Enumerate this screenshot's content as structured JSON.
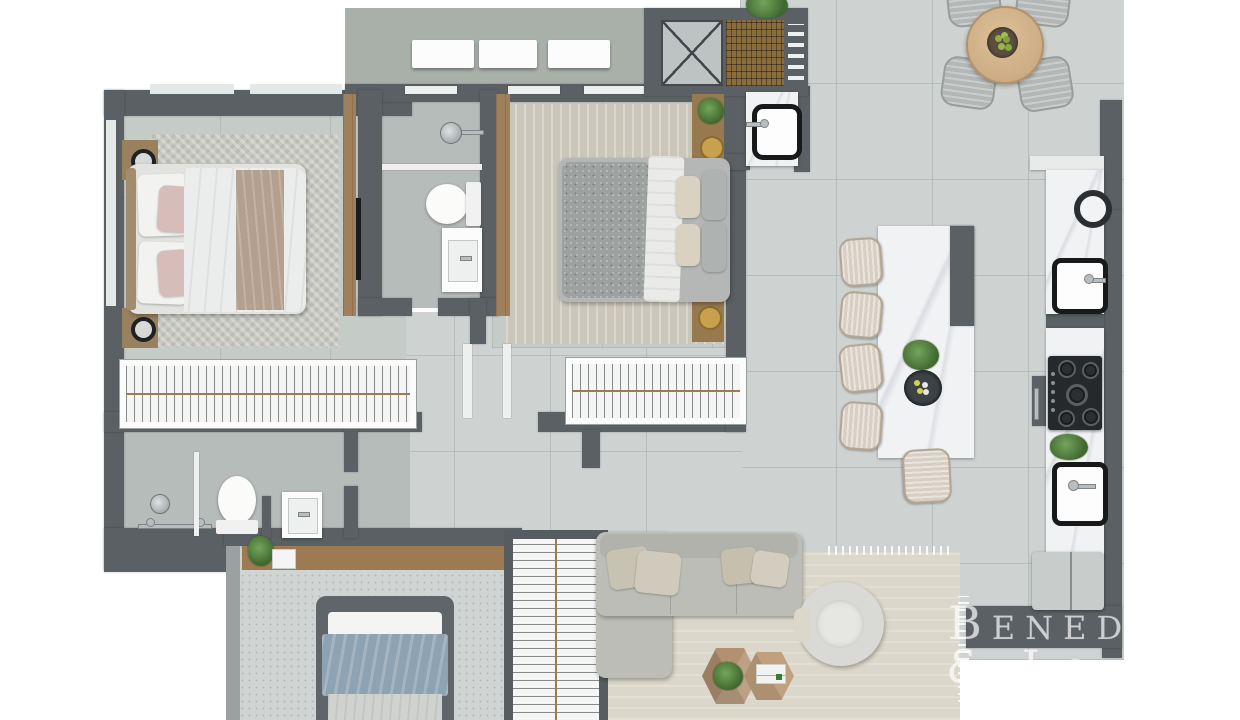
{
  "watermark": {
    "line1": "Beneduzi",
    "line2": "& Lopes"
  },
  "scene": {
    "type": "3d-rendered-apartment-floor-plan",
    "view": "top-down",
    "rooms": [
      {
        "id": "bedroom-1",
        "furniture": [
          "double-bed",
          "wood-headboard",
          "pillows-pink-white",
          "throw-blanket",
          "nightstand",
          "nightstand",
          "black-table-lamp",
          "black-table-lamp",
          "herringbone-rug",
          "wardrobe-panel",
          "tv-panel",
          "closet-hanger-rack"
        ]
      },
      {
        "id": "bathroom-1",
        "furniture": [
          "shower-head",
          "glass-shelf",
          "toilet",
          "vanity-sink"
        ]
      },
      {
        "id": "bedroom-2",
        "furniture": [
          "double-bed-gray-velvet",
          "white-throw",
          "pillows",
          "nightstand-plant-lamp",
          "nightstand-lamp",
          "rug",
          "wardrobe-panel",
          "closet-hanger-rack"
        ]
      },
      {
        "id": "service-area",
        "furniture": [
          "white-cabinet",
          "white-cabinet",
          "white-cabinet",
          "x-marked-shaft",
          "wood-grille",
          "louver-steps",
          "laundry-tub-sink",
          "plant"
        ]
      },
      {
        "id": "dining-area",
        "furniture": [
          "round-wood-table",
          "bowl-of-green-apples",
          "upholstered-chair",
          "upholstered-chair",
          "upholstered-chair",
          "upholstered-chair"
        ]
      },
      {
        "id": "kitchen",
        "furniture": [
          "marble-island",
          "island-plant",
          "serving-bowl",
          "bar-stool",
          "bar-stool",
          "bar-stool",
          "bar-stool",
          "bar-stool",
          "marble-counter",
          "vessel-ring",
          "black-sink",
          "gas-cooktop-4-burners",
          "counter-plant",
          "black-sink",
          "oven-cabinet",
          "refrigerator"
        ]
      },
      {
        "id": "bathroom-2",
        "furniture": [
          "shower-head",
          "shower-valves",
          "glass-partition",
          "toilet",
          "vanity-sink"
        ]
      },
      {
        "id": "bedroom-3",
        "furniture": [
          "single-bed-blue",
          "desk-shelf",
          "plant",
          "picture-frame",
          "closet-hanger-rack",
          "glass-wall"
        ]
      },
      {
        "id": "living-room",
        "furniture": [
          "l-shaped-sectional-sofa",
          "throw-pillows",
          "curved-armchair",
          "hex-coffee-table",
          "hex-coffee-table",
          "plant",
          "books",
          "fringed-area-rug"
        ]
      }
    ]
  },
  "palette": {
    "background": "#ffffff",
    "wall": "#5a6063",
    "floor_tile": "#ced3d2",
    "bedroom_floor": "#c5cbc7",
    "bathroom_floor": "#b6bcba",
    "wood": "#a0805a",
    "marble": "#f1f2f4",
    "sofa": "#bdbdb7",
    "rug_living": "#dbd7ca",
    "bed_blue": "#8da2b2",
    "bed_pink": "#d6bdba",
    "plant_green": "#4e7c3f",
    "chrome": "#b9bdbf",
    "watermark_color": "rgba(255,255,255,0.62)"
  }
}
